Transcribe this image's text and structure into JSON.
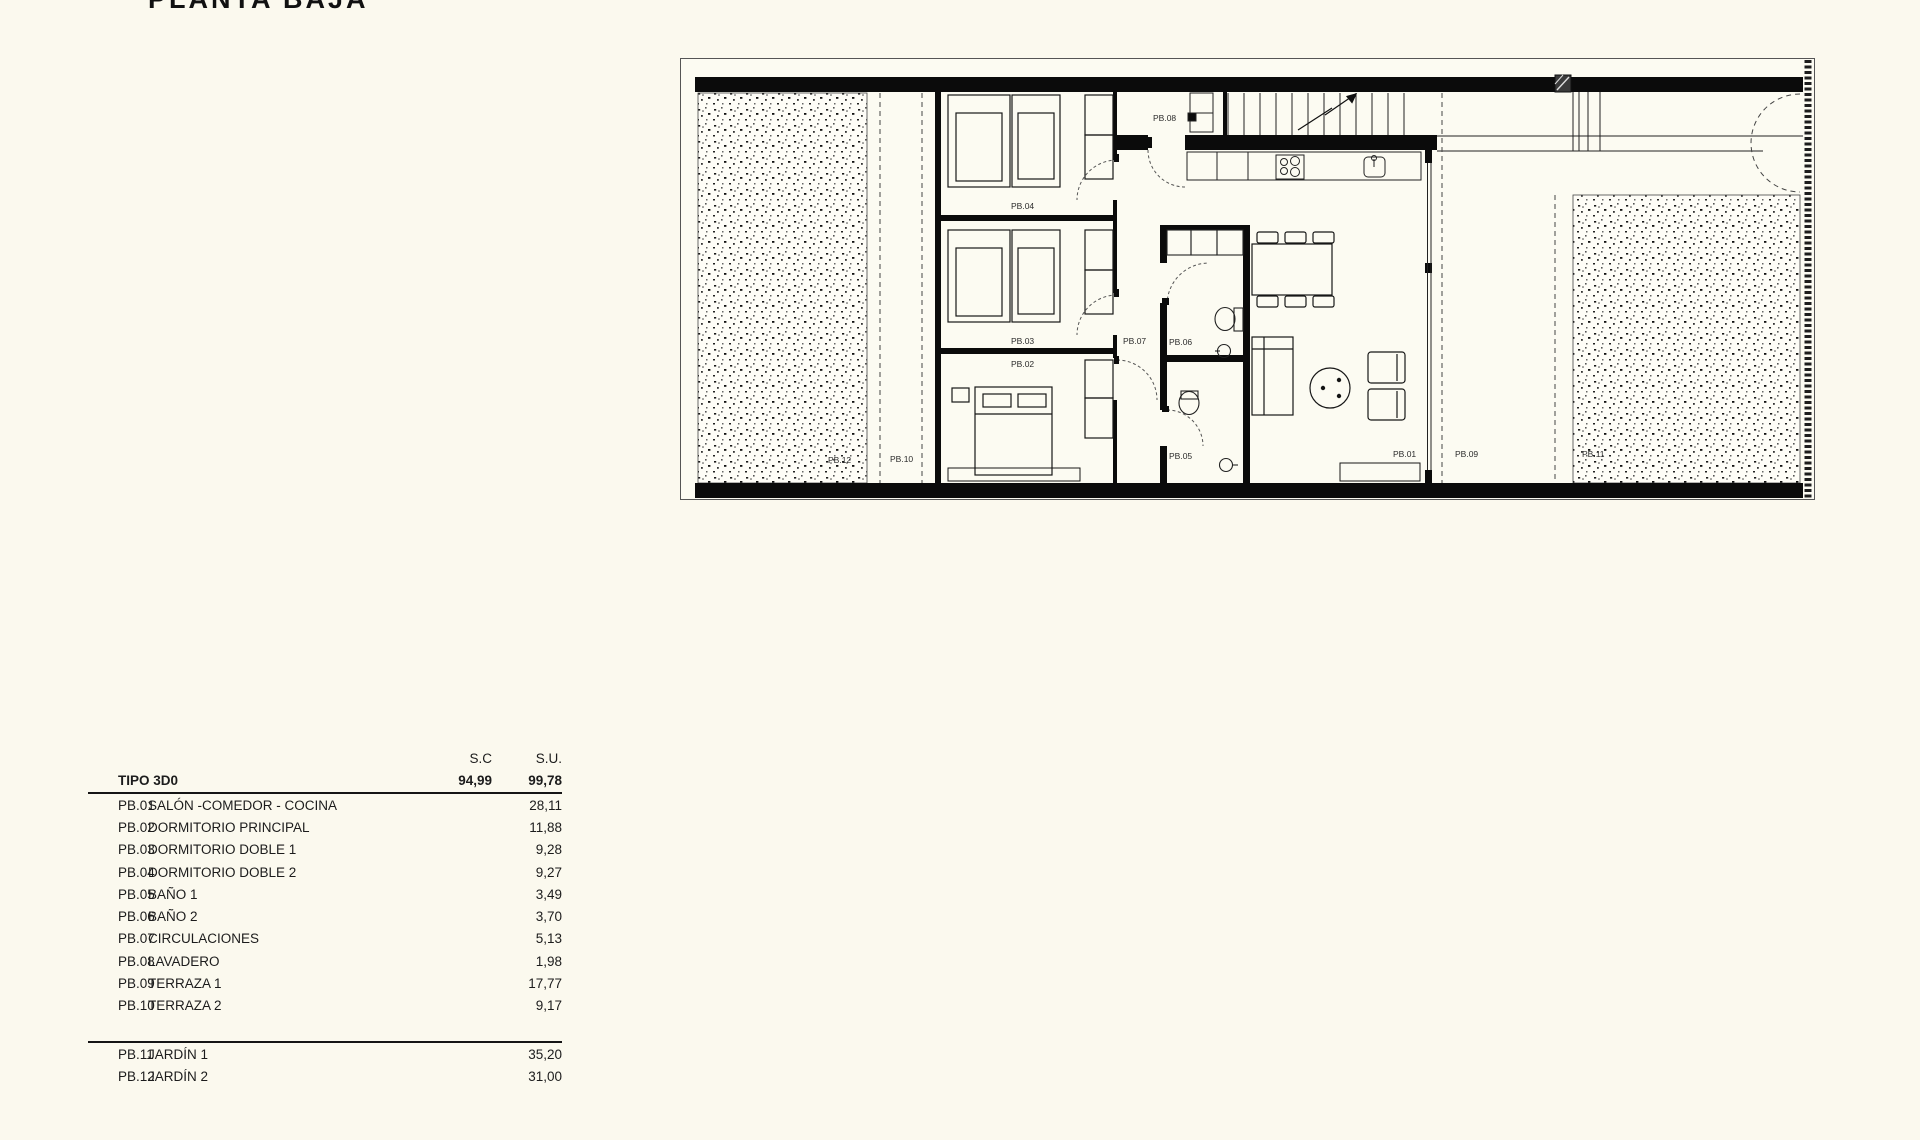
{
  "title": "PLANTA BAJA",
  "colors": {
    "paper": "#fbf9ee",
    "ink": "#111111",
    "label": "#2c2c2c"
  },
  "area_table": {
    "col_headers": {
      "sc": "S.C",
      "su": "S.U."
    },
    "type_row": {
      "label": "TIPO 3D0",
      "sc": "94,99",
      "su": "99,78"
    },
    "rooms": [
      {
        "code": "PB.01",
        "name": "SALÓN -COMEDOR - COCINA",
        "su": "28,11"
      },
      {
        "code": "PB.02",
        "name": "DORMITORIO PRINCIPAL",
        "su": "11,88"
      },
      {
        "code": "PB.03",
        "name": "DORMITORIO DOBLE 1",
        "su": "9,28"
      },
      {
        "code": "PB.04",
        "name": "DORMITORIO DOBLE 2",
        "su": "9,27"
      },
      {
        "code": "PB.05",
        "name": "BAÑO 1",
        "su": "3,49"
      },
      {
        "code": "PB.06",
        "name": "BAÑO 2",
        "su": "3,70"
      },
      {
        "code": "PB.07",
        "name": "CIRCULACIONES",
        "su": "5,13"
      },
      {
        "code": "PB.08",
        "name": "LAVADERO",
        "su": "1,98"
      },
      {
        "code": "PB.09",
        "name": "TERRAZA 1",
        "su": "17,77"
      },
      {
        "code": "PB.10",
        "name": "TERRAZA 2",
        "su": "9,17"
      }
    ],
    "outdoor": [
      {
        "code": "PB.11",
        "name": "JARDÍN 1",
        "su": "35,20"
      },
      {
        "code": "PB.12",
        "name": "JARDÍN 2",
        "su": "31,00"
      }
    ]
  },
  "plan": {
    "labels": {
      "pb01": "PB.01",
      "pb02": "PB.02",
      "pb03": "PB.03",
      "pb04": "PB.04",
      "pb05": "PB.05",
      "pb06": "PB.06",
      "pb07": "PB.07",
      "pb08": "PB.08",
      "pb09": "PB.09",
      "pb10": "PB.10",
      "pb11": "PB.11",
      "pb12": "PB.12"
    }
  }
}
